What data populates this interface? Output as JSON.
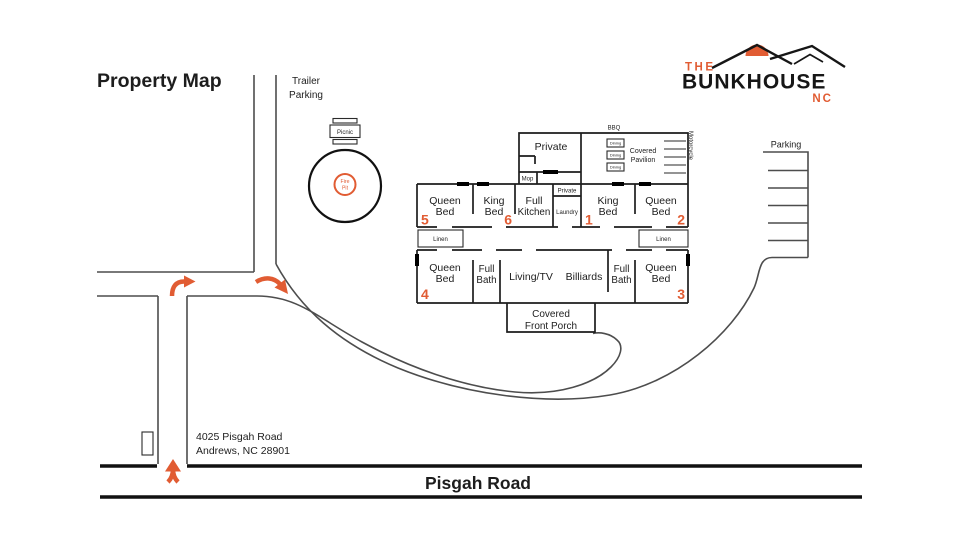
{
  "title": "Property Map",
  "logo": {
    "the": "THE",
    "name": "BUNKHOUSE",
    "nc": "NC"
  },
  "colors": {
    "accent": "#E15C33",
    "wall": "#1d1d1d",
    "road": "#4d4d4d"
  },
  "site": {
    "trailer_parking_1": "Trailer",
    "trailer_parking_2": "Parking",
    "picnic": "Picnic",
    "fire_1": "Fire",
    "fire_2": "Pit",
    "bbq": "BBQ",
    "dining": "Dining",
    "pavilion_1": "Covered",
    "pavilion_2": "Pavilion",
    "motorcycle": "Motorcycle",
    "parking": "Parking",
    "porch_1": "Covered",
    "porch_2": "Front Porch",
    "address_1": "4025 Pisgah Road",
    "address_2": "Andrews, NC 28901",
    "road": "Pisgah Road"
  },
  "rooms": {
    "queen5": {
      "line1": "Queen",
      "line2": "Bed",
      "num": "5"
    },
    "king6": {
      "line1": "King",
      "line2": "Bed",
      "num": "6"
    },
    "kitchen": {
      "line1": "Full",
      "line2": "Kitchen"
    },
    "private_upper": "Private",
    "private_small": "Private",
    "laundry": "Laundry",
    "mop": "Mop",
    "king1": {
      "line1": "King",
      "line2": "Bed",
      "num": "1"
    },
    "queen2": {
      "line1": "Queen",
      "line2": "Bed",
      "num": "2"
    },
    "linen_left": "Linen",
    "linen_right": "Linen",
    "queen4": {
      "line1": "Queen",
      "line2": "Bed",
      "num": "4"
    },
    "bath_left": {
      "line1": "Full",
      "line2": "Bath"
    },
    "living": "Living/TV",
    "billiards": "Billiards",
    "bath_right": {
      "line1": "Full",
      "line2": "Bath"
    },
    "queen3": {
      "line1": "Queen",
      "line2": "Bed",
      "num": "3"
    }
  }
}
